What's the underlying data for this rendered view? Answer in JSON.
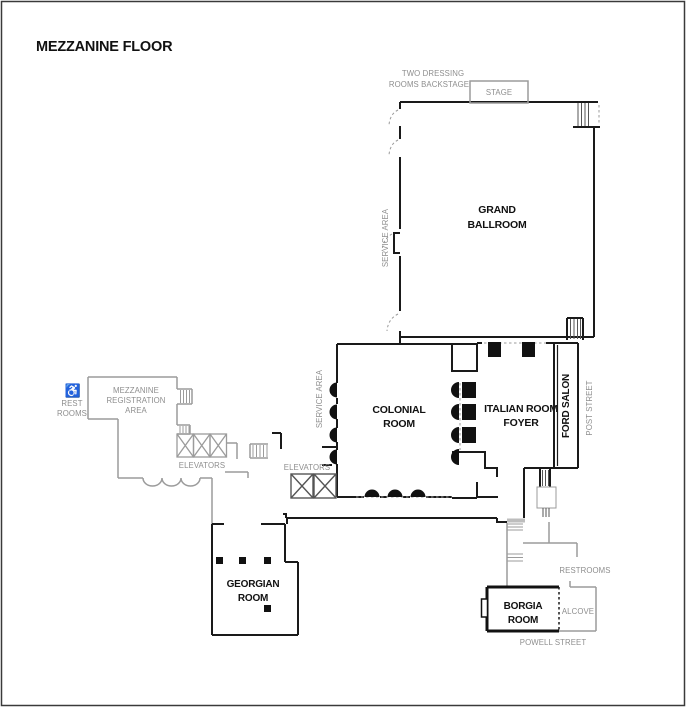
{
  "title": "MEZZANINE FLOOR",
  "labels": {
    "dressing_line1": "TWO DRESSING",
    "dressing_line2": "ROOMS BACKSTAGE",
    "stage": "STAGE",
    "grand_line1": "GRAND",
    "grand_line2": "BALLROOM",
    "service_area_upper": "SERVICE AREA",
    "service_area_lower": "SERVICE AREA",
    "colonial_line1": "COLONIAL",
    "colonial_line2": "ROOM",
    "italian_line1": "ITALIAN ROOM",
    "italian_line2": "FOYER",
    "ford_salon": "FORD SALON",
    "post_street": "POST STREET",
    "mezz_line1": "MEZZANINE",
    "mezz_line2": "REGISTRATION",
    "mezz_line3": "AREA",
    "rest_line1": "REST",
    "rest_line2": "ROOMS",
    "elevators_west": "ELEVATORS",
    "elevators_central": "ELEVATORS",
    "georgian_line1": "GEORGIAN",
    "georgian_line2": "ROOM",
    "restrooms": "RESTROOMS",
    "borgia_line1": "BORGIA",
    "borgia_line2": "ROOM",
    "alcove": "ALCOVE",
    "powell_street": "POWELL STREET"
  },
  "icons": {
    "wheelchair": "♿"
  },
  "colors": {
    "wall_black": "#1a1a1a",
    "wall_gray": "#9b9b9b",
    "text_gray": "#8e8e8e",
    "text_black": "#111111",
    "page_border": "#3a3a3a"
  }
}
